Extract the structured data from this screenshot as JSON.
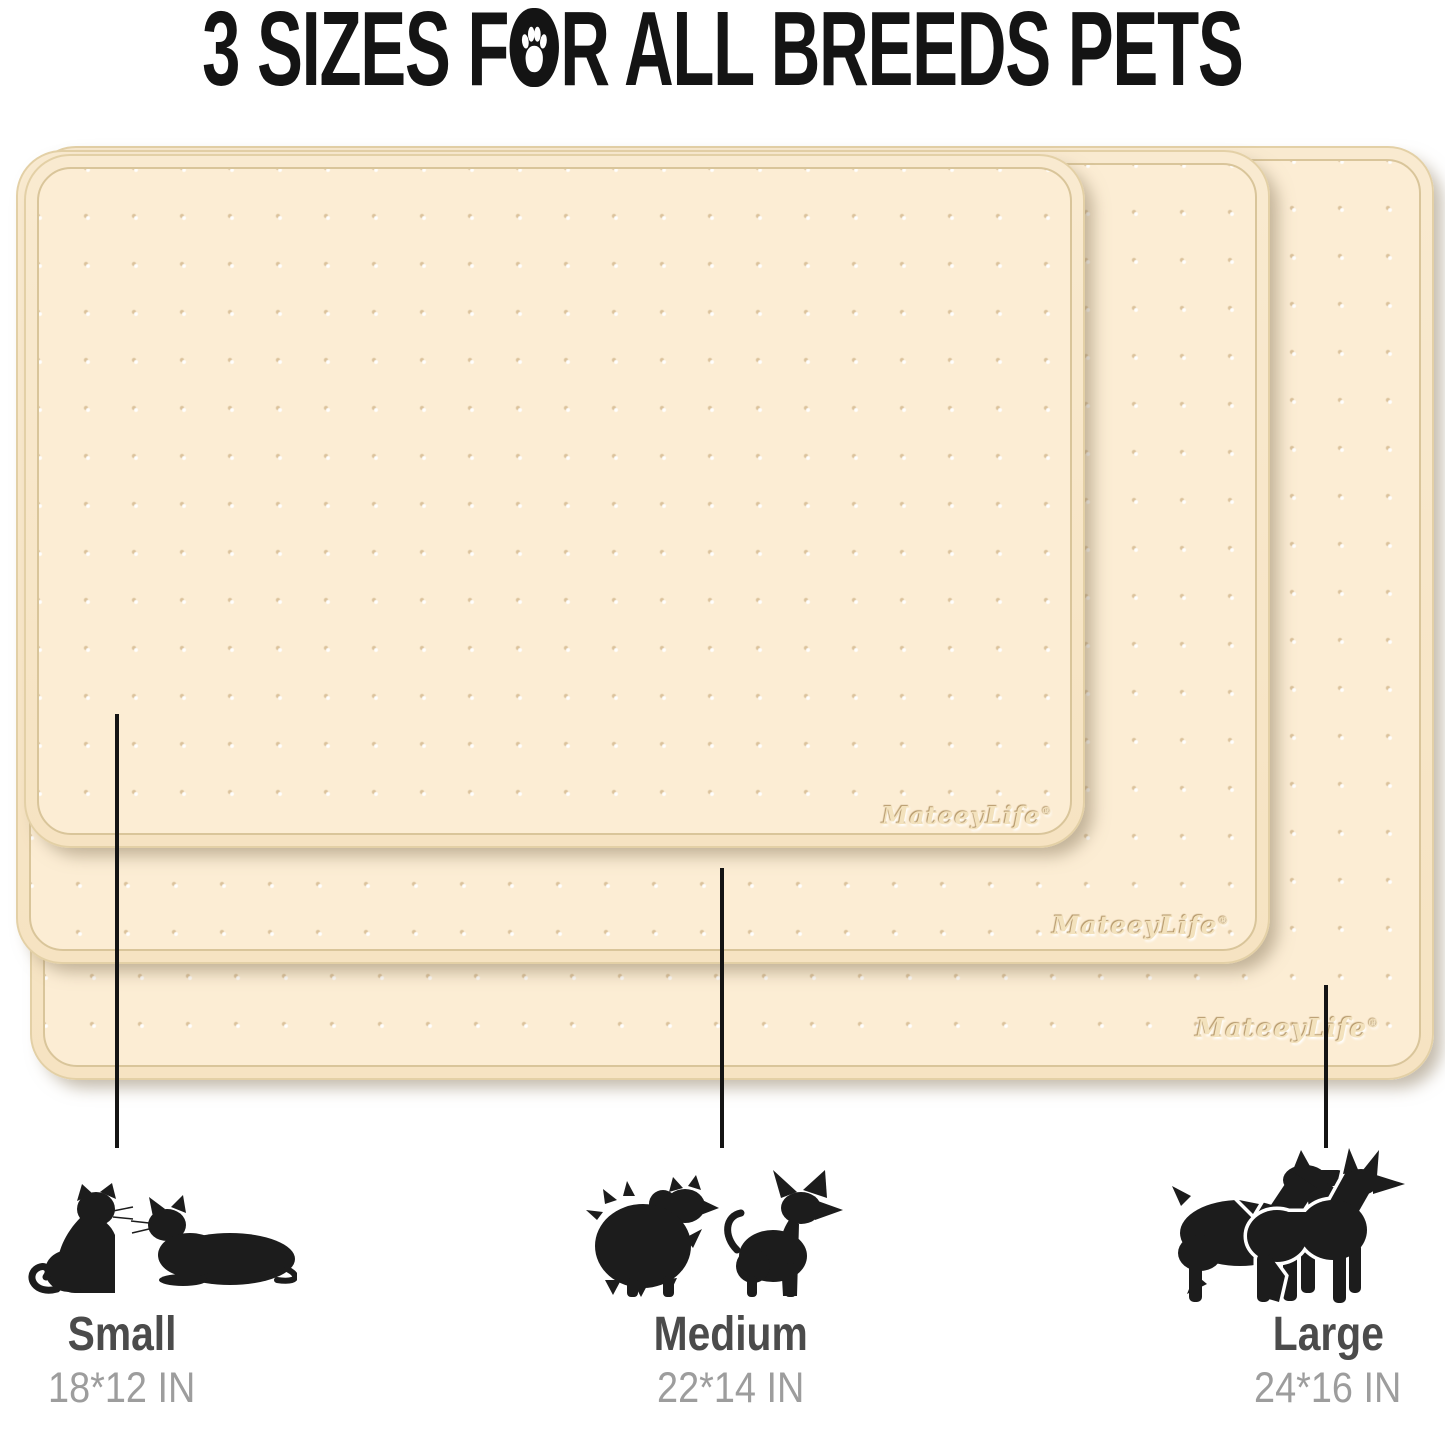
{
  "title": {
    "part1": "3 SIZES F",
    "part2": "R ALL BREEDS PETS"
  },
  "brand": {
    "name": "MateeyLife",
    "registered": "®"
  },
  "sizes": [
    {
      "label": "Small",
      "dimensions": "18*12 IN"
    },
    {
      "label": "Medium",
      "dimensions": "22*14 IN"
    },
    {
      "label": "Large",
      "dimensions": "24*16 IN"
    }
  ],
  "icons": {
    "title_paw": "paw-print",
    "small_group": [
      "sitting-cat",
      "lying-cat"
    ],
    "medium_group": [
      "pomeranian-dog",
      "chihuahua-dog"
    ],
    "large_group": [
      "schnauzer-dog",
      "doberman-dog"
    ]
  },
  "colors": {
    "mat_surface": "#fcedd4",
    "mat_edge": "#e3d0a6",
    "rim_line": "#d9c59a",
    "title_text": "#141414",
    "size_label": "#4b4b4b",
    "dimension_text": "#9d9d9d",
    "silhouette": "#1c1c1c",
    "callout_line": "#141414"
  }
}
